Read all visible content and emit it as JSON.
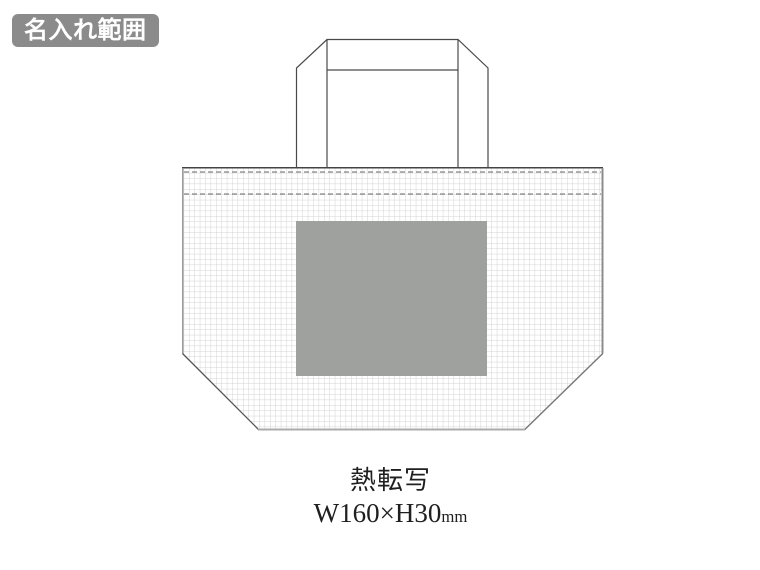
{
  "badge": {
    "label": "名入れ範囲"
  },
  "caption": {
    "method": "熱転写",
    "size": "W160×H30",
    "size_unit": "mm"
  },
  "colors": {
    "badge_bg": "#8b8b8b",
    "badge_text": "#ffffff",
    "print_area": "#9fa19f",
    "grid_line": "#d0d0d0",
    "outline_dark": "#4a4a4a",
    "stitch_dash": "#6a6a6a",
    "caption_text": "#1f1f1f"
  }
}
